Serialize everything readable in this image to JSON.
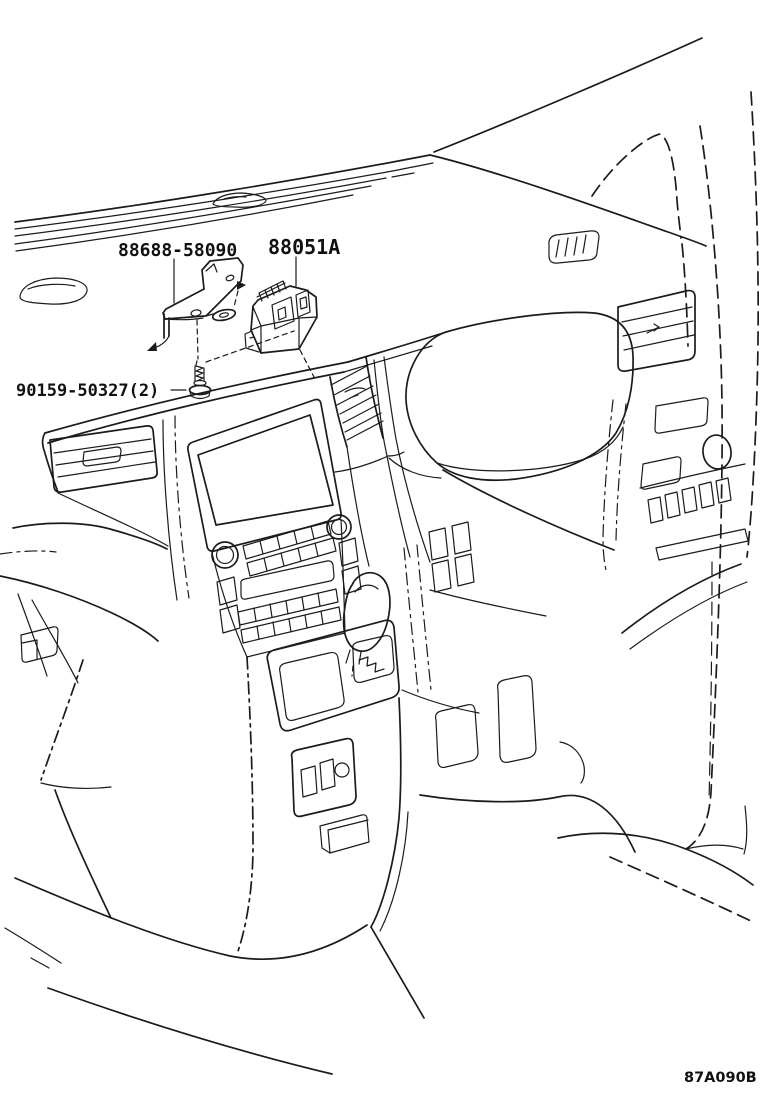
{
  "figure": {
    "background_color": "#ffffff",
    "line_color": "#1b1b1b",
    "callouts": [
      {
        "id": "bracket",
        "part_number": "88688-58090"
      },
      {
        "id": "computer",
        "part_number": "88051A"
      },
      {
        "id": "screw",
        "part_number": "90159-50327(2)"
      }
    ],
    "figure_code": "87A090B"
  }
}
